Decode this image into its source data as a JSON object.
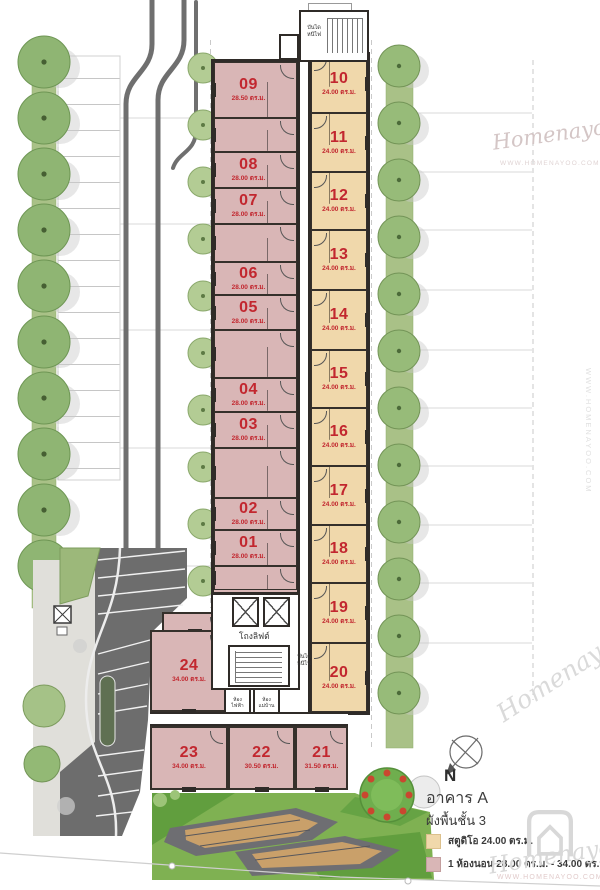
{
  "title": {
    "building": "อาคาร A",
    "floor_plan": "ผังพื้นชั้น 3"
  },
  "compass": {
    "label": "N"
  },
  "legend": [
    {
      "label": "สตูดิโอ 24.00 ตร.ม.",
      "color": "#f0d8ab",
      "type": "studio"
    },
    {
      "label": "1 ห้องนอน 28.00 ตร.ม. - 34.00 ตร.ม.",
      "color": "#d9b6b6",
      "type": "one-bedroom"
    }
  ],
  "colors": {
    "wall": "#2f2b28",
    "unit_number": "#c2272f",
    "studio_fill": "#f0d8ab",
    "one_bed_fill": "#d9b6b6"
  },
  "labels": {
    "fire_stair_top": "บันได\nหนีไฟ",
    "fire_stair_mid": "บันได\nหนีไฟ",
    "lift_lobby": "โถงลิฟต์",
    "electrical_room": "ห้อง\nไฟฟ้า",
    "maid_room": "ห้อง\nแม่บ้าน"
  },
  "watermark": {
    "name": "Homenayoo",
    "url": "WWW.HOMENAYOO.COM"
  },
  "units": {
    "one_bedroom_wing": [
      {
        "no": "09",
        "area": "28.50 ตร.ม.",
        "x": 214,
        "y": 62,
        "w": 83,
        "h": 56
      },
      {
        "no": "",
        "area": "",
        "x": 214,
        "y": 118,
        "w": 83,
        "h": 34
      },
      {
        "no": "08",
        "area": "28.00 ตร.ม.",
        "x": 214,
        "y": 152,
        "w": 83,
        "h": 36
      },
      {
        "no": "07",
        "area": "28.00 ตร.ม.",
        "x": 214,
        "y": 188,
        "w": 83,
        "h": 36
      },
      {
        "no": "",
        "area": "",
        "x": 214,
        "y": 224,
        "w": 83,
        "h": 38
      },
      {
        "no": "06",
        "area": "28.00 ตร.ม.",
        "x": 214,
        "y": 262,
        "w": 83,
        "h": 33
      },
      {
        "no": "05",
        "area": "28.00 ตร.ม.",
        "x": 214,
        "y": 295,
        "w": 83,
        "h": 35
      },
      {
        "no": "",
        "area": "",
        "x": 214,
        "y": 330,
        "w": 83,
        "h": 48
      },
      {
        "no": "04",
        "area": "28.00 ตร.ม.",
        "x": 214,
        "y": 378,
        "w": 83,
        "h": 34
      },
      {
        "no": "03",
        "area": "28.00 ตร.ม.",
        "x": 214,
        "y": 412,
        "w": 83,
        "h": 36
      },
      {
        "no": "",
        "area": "",
        "x": 214,
        "y": 448,
        "w": 83,
        "h": 50
      },
      {
        "no": "02",
        "area": "28.00 ตร.ม.",
        "x": 214,
        "y": 498,
        "w": 83,
        "h": 32
      },
      {
        "no": "01",
        "area": "28.00 ตร.ม.",
        "x": 214,
        "y": 530,
        "w": 83,
        "h": 36
      },
      {
        "no": "",
        "area": "",
        "x": 214,
        "y": 566,
        "w": 83,
        "h": 24
      }
    ],
    "studio_wing": [
      {
        "no": "10",
        "area": "24.00 ตร.ม.",
        "x": 311,
        "y": 55,
        "w": 56,
        "h": 58
      },
      {
        "no": "11",
        "area": "24.00 ตร.ม.",
        "x": 311,
        "y": 113,
        "w": 56,
        "h": 59
      },
      {
        "no": "12",
        "area": "24.00 ตร.ม.",
        "x": 311,
        "y": 172,
        "w": 56,
        "h": 58
      },
      {
        "no": "13",
        "area": "24.00 ตร.ม.",
        "x": 311,
        "y": 230,
        "w": 56,
        "h": 60
      },
      {
        "no": "14",
        "area": "24.00 ตร.ม.",
        "x": 311,
        "y": 290,
        "w": 56,
        "h": 60
      },
      {
        "no": "15",
        "area": "24.00 ตร.ม.",
        "x": 311,
        "y": 350,
        "w": 56,
        "h": 58
      },
      {
        "no": "16",
        "area": "24.00 ตร.ม.",
        "x": 311,
        "y": 408,
        "w": 56,
        "h": 58
      },
      {
        "no": "17",
        "area": "24.00 ตร.ม.",
        "x": 311,
        "y": 466,
        "w": 56,
        "h": 59
      },
      {
        "no": "18",
        "area": "24.00 ตร.ม.",
        "x": 311,
        "y": 525,
        "w": 56,
        "h": 58
      },
      {
        "no": "19",
        "area": "24.00 ตร.ม.",
        "x": 311,
        "y": 583,
        "w": 56,
        "h": 60
      },
      {
        "no": "20",
        "area": "24.00 ตร.ม.",
        "x": 311,
        "y": 643,
        "w": 56,
        "h": 69
      }
    ],
    "lower_block": [
      {
        "no": "",
        "area": "",
        "x": 162,
        "y": 612,
        "w": 66,
        "h": 20
      },
      {
        "no": "24",
        "area": "34.00 ตร.ม.",
        "x": 150,
        "y": 630,
        "w": 78,
        "h": 82
      },
      {
        "no": "23",
        "area": "34.00 ตร.ม.",
        "x": 150,
        "y": 726,
        "w": 78,
        "h": 64
      },
      {
        "no": "22",
        "area": "30.50 ตร.ม.",
        "x": 228,
        "y": 726,
        "w": 67,
        "h": 64
      },
      {
        "no": "21",
        "area": "31.50 ตร.ม.",
        "x": 295,
        "y": 726,
        "w": 53,
        "h": 64
      }
    ]
  }
}
